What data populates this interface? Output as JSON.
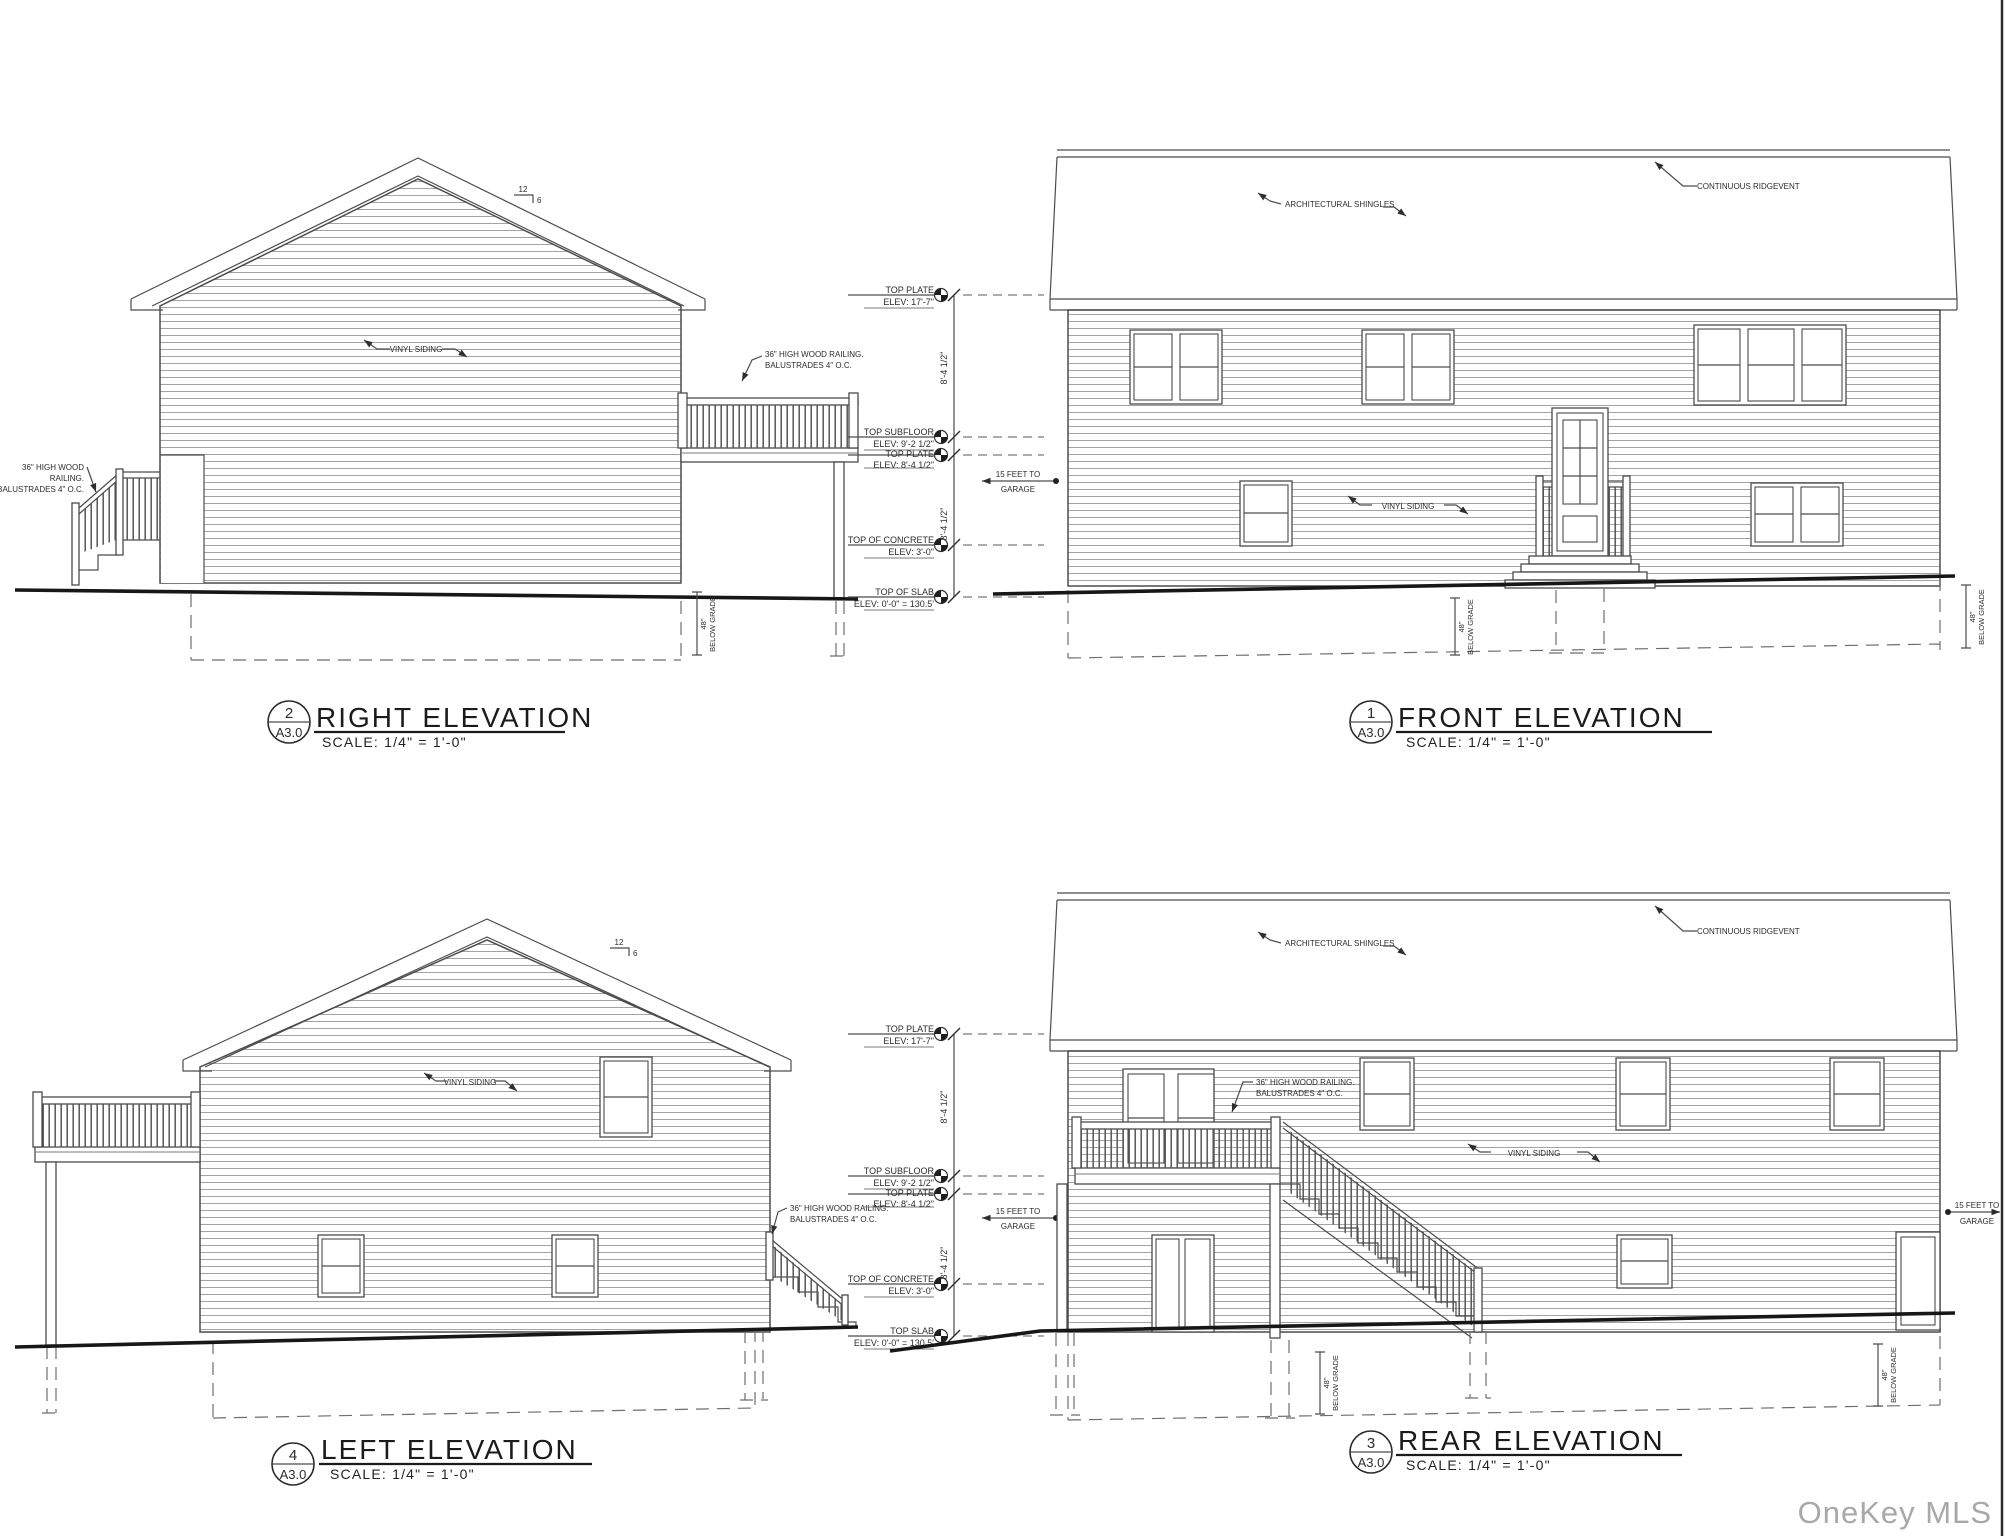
{
  "watermark": "OneKey MLS",
  "titles": {
    "right": {
      "num": "2",
      "sheet": "A3.0",
      "label": "RIGHT ELEVATION",
      "scale": "SCALE: 1/4\" = 1'-0\""
    },
    "front": {
      "num": "1",
      "sheet": "A3.0",
      "label": "FRONT ELEVATION",
      "scale": "SCALE: 1/4\" = 1'-0\""
    },
    "left": {
      "num": "4",
      "sheet": "A3.0",
      "label": "LEFT ELEVATION",
      "scale": "SCALE: 1/4\" = 1'-0\""
    },
    "rear": {
      "num": "3",
      "sheet": "A3.0",
      "label": "REAR ELEVATION",
      "scale": "SCALE: 1/4\" = 1'-0\""
    }
  },
  "dims": {
    "span": "8'-4 1/2\"",
    "upper": [
      {
        "name": "TOP PLATE",
        "elev": "ELEV: 17'-7\""
      },
      {
        "name": "TOP SUBFLOOR",
        "elev": "ELEV: 9'-2 1/2\""
      },
      {
        "name": "TOP PLATE",
        "elev": "ELEV: 8'-4 1/2\""
      },
      {
        "name": "TOP OF CONCRETE",
        "elev": "ELEV: 3'-0\""
      },
      {
        "name": "TOP OF SLAB",
        "elev": "ELEV: 0'-0\" = 130.5'"
      }
    ],
    "lower": [
      {
        "name": "TOP PLATE",
        "elev": "ELEV: 17'-7\""
      },
      {
        "name": "TOP SUBFLOOR",
        "elev": "ELEV: 9'-2 1/2\""
      },
      {
        "name": "TOP PLATE",
        "elev": "ELEV: 8'-4 1/2\""
      },
      {
        "name": "TOP OF CONCRETE",
        "elev": "ELEV: 3'-0\""
      },
      {
        "name": "TOP SLAB",
        "elev": "ELEV: 0'-0\" = 130.5'"
      }
    ]
  },
  "ann": {
    "vinyl": "VINYL SIDING",
    "shingles": "ARCHITECTURAL SHINGLES",
    "ridgevent": "CONTINUOUS RIDGEVENT",
    "rail1": "36\" HIGH WOOD RAILING.",
    "rail2": "BALUSTRADES 4\" O.C.",
    "rail_s1": "36\" HIGH WOOD",
    "rail_s2": "RAILING.",
    "rail_s3": "BALUSTRADES 4\" O.C.",
    "gar1": "15 FEET TO",
    "gar2": "GARAGE",
    "bg1": "48\"",
    "bg2": "BELOW GRADE",
    "rise": "12",
    "run": "6"
  }
}
